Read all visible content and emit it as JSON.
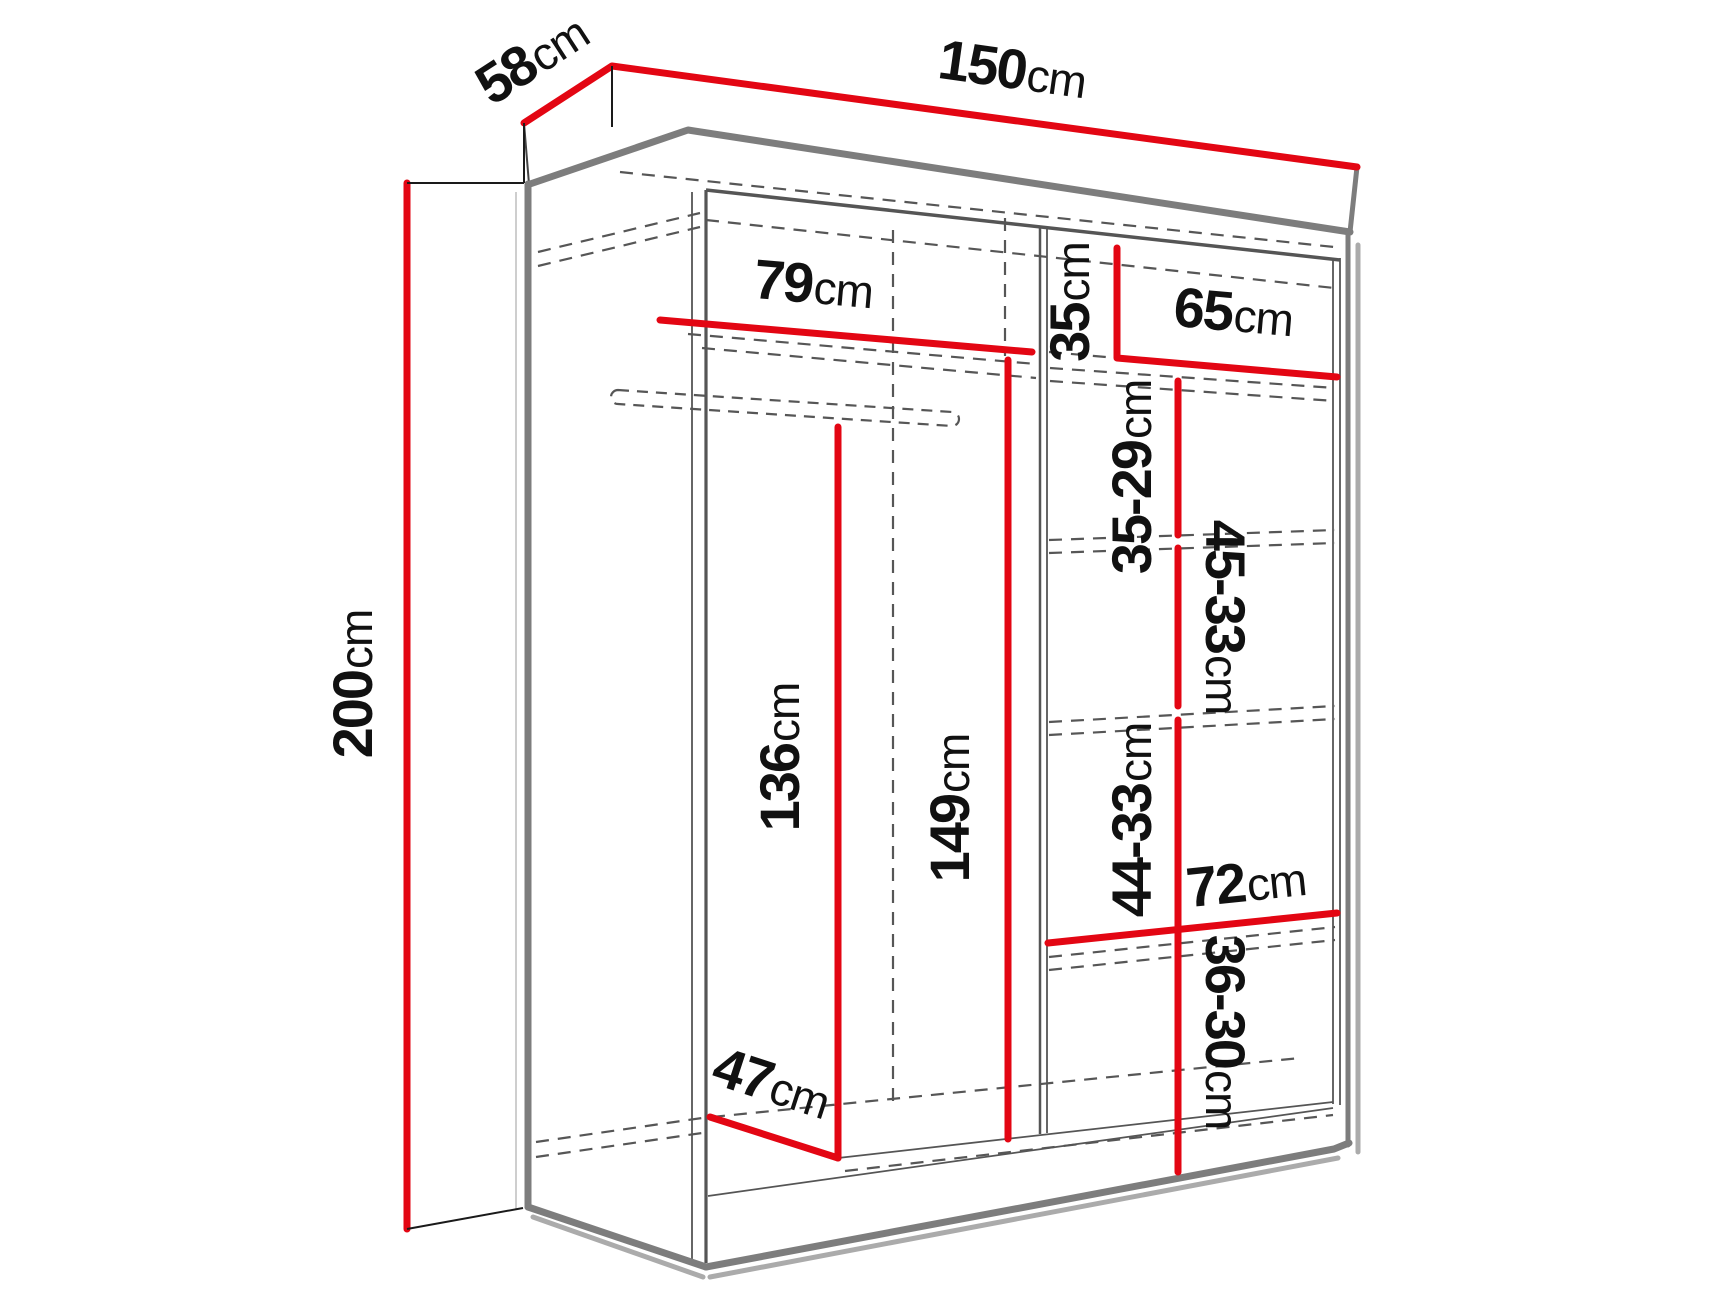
{
  "diagram": {
    "type": "furniture-dimension-diagram",
    "subject": "wardrobe interior dimensions, perspective line drawing",
    "unit": "cm",
    "accent_color": "#e30613",
    "outline_color": "#7d7d7d",
    "shadow_color": "#ababab",
    "hidden_edge_color": "#565656",
    "text_color": "#111111",
    "labels": {
      "depth": {
        "num": "58",
        "unit": "cm"
      },
      "width": {
        "num": "150",
        "unit": "cm"
      },
      "height": {
        "num": "200",
        "unit": "cm"
      },
      "left_shelf_width": {
        "num": "79",
        "unit": "cm"
      },
      "right_top_space": {
        "num": "35",
        "unit": "cm"
      },
      "right_shelf_width": {
        "num": "65",
        "unit": "cm"
      },
      "right_space_1": {
        "num": "35-29",
        "unit": "cm"
      },
      "right_space_2": {
        "num": "45-33",
        "unit": "cm"
      },
      "hanging_space_height": {
        "num": "136",
        "unit": "cm"
      },
      "left_interior_height": {
        "num": "149",
        "unit": "cm"
      },
      "right_space_3": {
        "num": "44-33",
        "unit": "cm"
      },
      "bottom_shelf_width": {
        "num": "72",
        "unit": "cm"
      },
      "right_space_4": {
        "num": "36-30",
        "unit": "cm"
      },
      "interior_depth": {
        "num": "47",
        "unit": "cm"
      }
    }
  }
}
